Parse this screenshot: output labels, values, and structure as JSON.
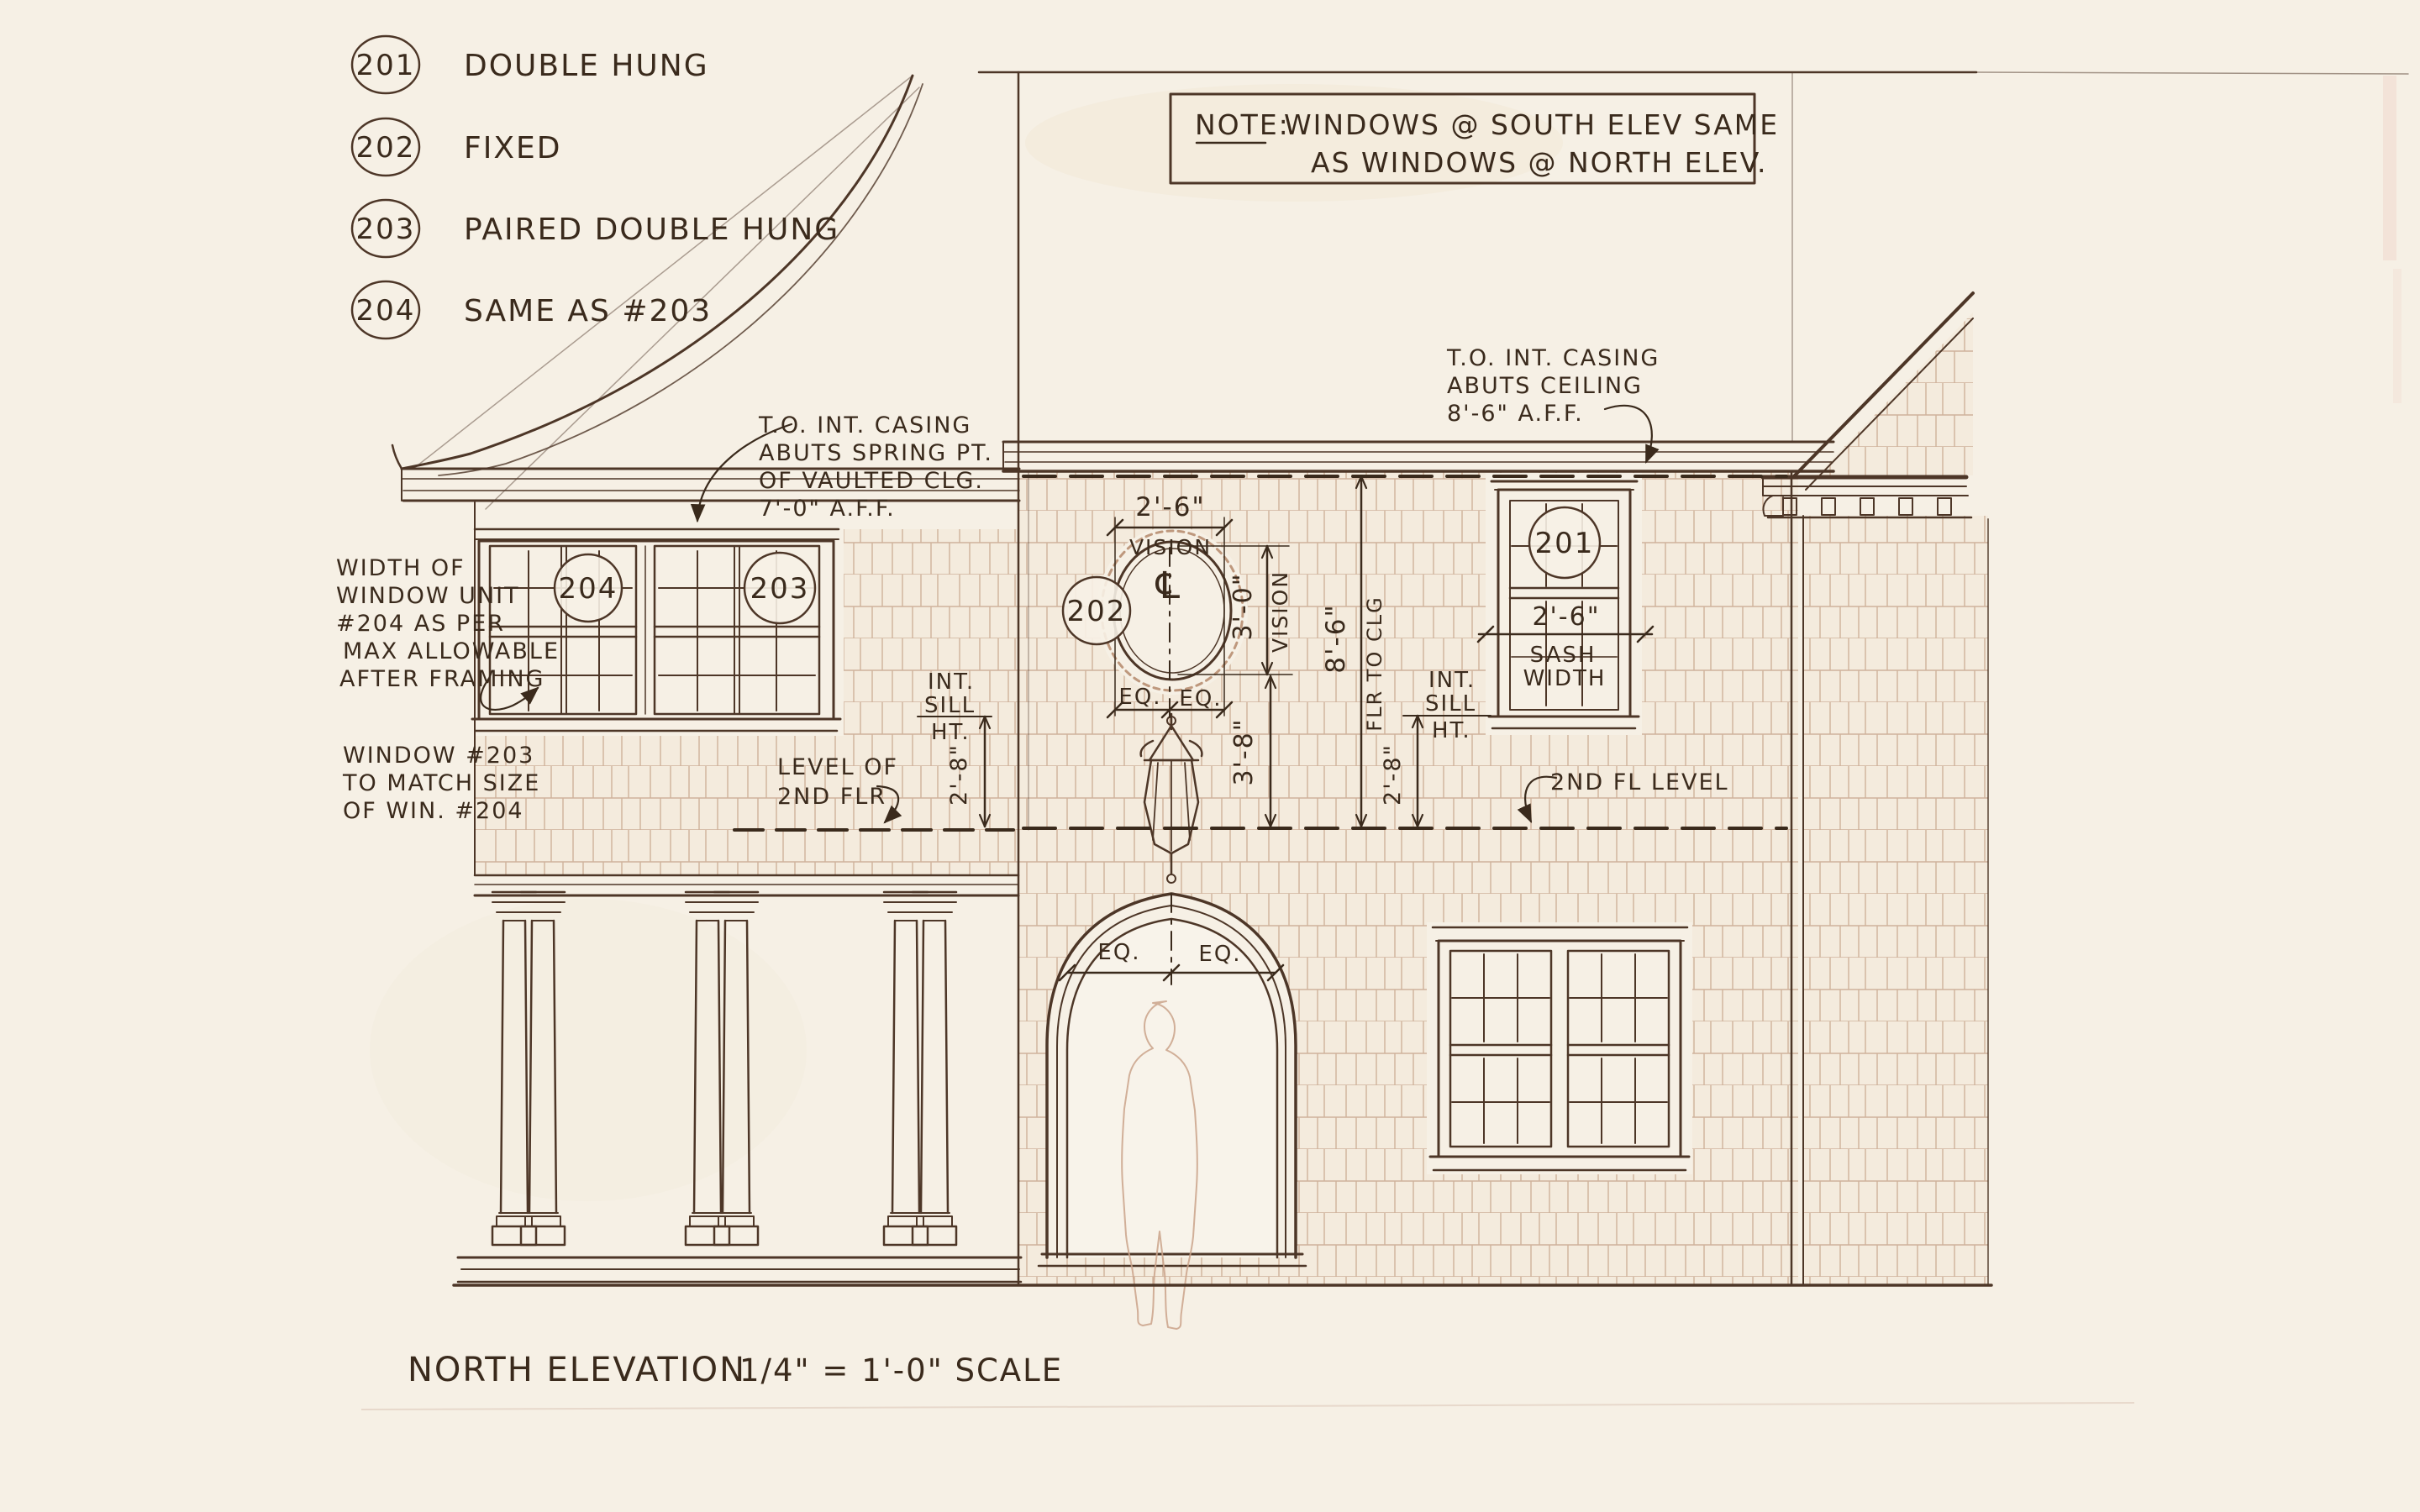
{
  "sheet": {
    "title": "North Elevation",
    "scale": "1/4\" = 1'-0\" Scale"
  },
  "legend": {
    "items": [
      {
        "number": "201",
        "label": "Double Hung"
      },
      {
        "number": "202",
        "label": "Fixed"
      },
      {
        "number": "203",
        "label": "Paired Double Hung"
      },
      {
        "number": "204",
        "label": "Same as #203"
      }
    ]
  },
  "note_box": {
    "heading": "Note:",
    "line1": "Windows @ South Elev Same",
    "line2": "as Windows @ North Elev."
  },
  "annotations": {
    "casing_spring": {
      "l1": "T.O. Int. Casing",
      "l2": "Abuts Spring Pt.",
      "l3": "of Vaulted Clg.",
      "l4": "7'-0\" A.F.F."
    },
    "casing_ceiling": {
      "l1": "T.O. Int. Casing",
      "l2": "Abuts Ceiling",
      "l3": "8'-6\" A.F.F."
    },
    "width_note": {
      "l1": "Width of",
      "l2": "Window Unit",
      "l3": "#204 as per",
      "l4": "Max Allowable",
      "l5": "After Framing"
    },
    "match_note": {
      "l1": "Window #203",
      "l2": "to Match Size",
      "l3": "of Win. #204"
    },
    "sill_left": {
      "l1": "Int.",
      "l2": "Sill",
      "l3": "Ht."
    },
    "sill_right": {
      "l1": "Int.",
      "l2": "Sill",
      "l3": "Ht."
    },
    "level_2nd": {
      "l1": "Level of",
      "l2": "2nd Flr"
    },
    "second_fl_level": "2nd Fl Level"
  },
  "dimensions": {
    "oval_width": "2'-6\"",
    "oval_width_label": "Vision",
    "oval_height": "3'-0\"",
    "oval_height_label": "Vision",
    "oval_eq_left": "EQ.",
    "oval_eq_right": "EQ.",
    "centerline_symbol": "℄",
    "sill_to_floor_left": "2'-8\"",
    "vision_to_floor": "3'-8\"",
    "floor_to_ceiling": "8'-6\"",
    "floor_to_ceiling_label": "Flr to Clg",
    "sill_to_floor_right": "2'-8\"",
    "sash_width": "2'-6\"",
    "sash_width_l1": "Sash",
    "sash_width_l2": "Width",
    "door_eq_left": "EQ.",
    "door_eq_right": "EQ."
  },
  "window_tags": {
    "w201": "201",
    "w202": "202",
    "w203": "203",
    "w204": "204"
  },
  "colors": {
    "ink": "#4d3627",
    "lettering": "#3a2a1c",
    "sketch": "#b08263",
    "paper": "#f6f0e5"
  }
}
